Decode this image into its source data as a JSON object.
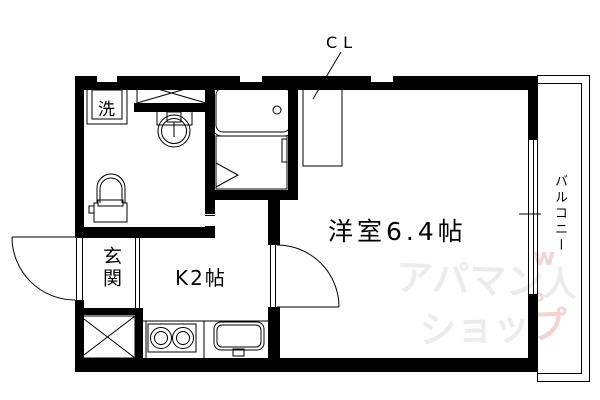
{
  "plan": {
    "type_note": "apartment floor plan",
    "labels": {
      "closet": "CL",
      "main_room": "洋室6.4帖",
      "kitchen": "K2帖",
      "entrance": "玄関",
      "washer": "洗",
      "balcony": "バルコニー"
    },
    "watermark": {
      "line1_gray": "アパマン",
      "mascot": "人",
      "crown": "w",
      "line2_gray": "ショッ",
      "line2_pink": "プ",
      "degree": "°",
      "gray_color": "#ececec",
      "pink_color": "#f2d4d4"
    },
    "colors": {
      "wall": "#000000",
      "background": "#ffffff",
      "line": "#000000"
    }
  }
}
